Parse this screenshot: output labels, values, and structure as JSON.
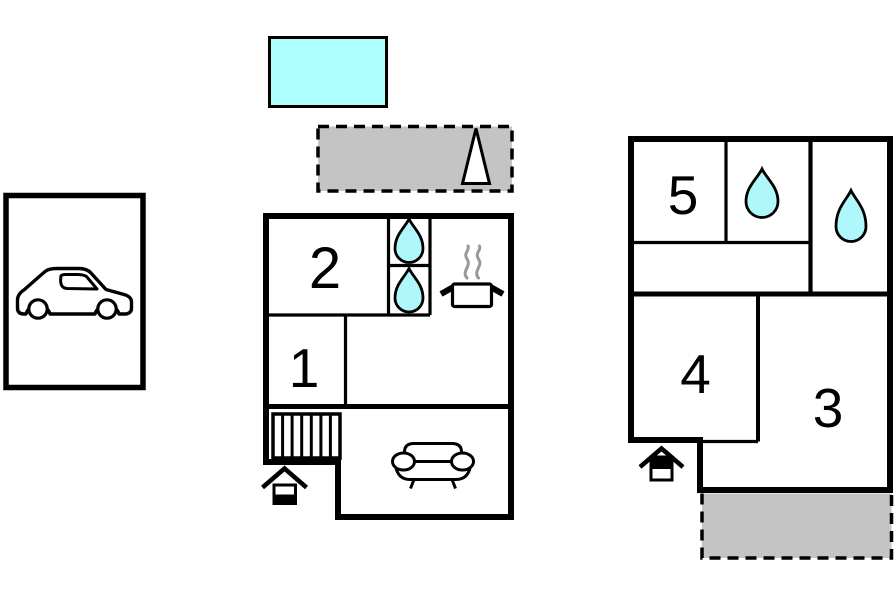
{
  "canvas": {
    "width": 896,
    "height": 597,
    "background": "#ffffff"
  },
  "colors": {
    "wall": "#000000",
    "pool_fill": "#aeffff",
    "water_drop_fill": "#b0f7fb",
    "area_fill": "#c4c4c4",
    "icon_fill": "#ffffff",
    "steam": "#999999",
    "text": "#000000"
  },
  "rooms": {
    "room1": {
      "number": "1"
    },
    "room2": {
      "number": "2"
    },
    "room3": {
      "number": "3"
    },
    "room4": {
      "number": "4"
    },
    "room5": {
      "number": "5"
    }
  },
  "icons": {
    "car": "car-icon",
    "water_drop": "water-drop-icon",
    "stove": "stove-icon",
    "stairs": "stairs-icon",
    "sofa": "sofa-icon",
    "entrance": "entrance-arrow-icon",
    "tree": "tree-icon"
  }
}
